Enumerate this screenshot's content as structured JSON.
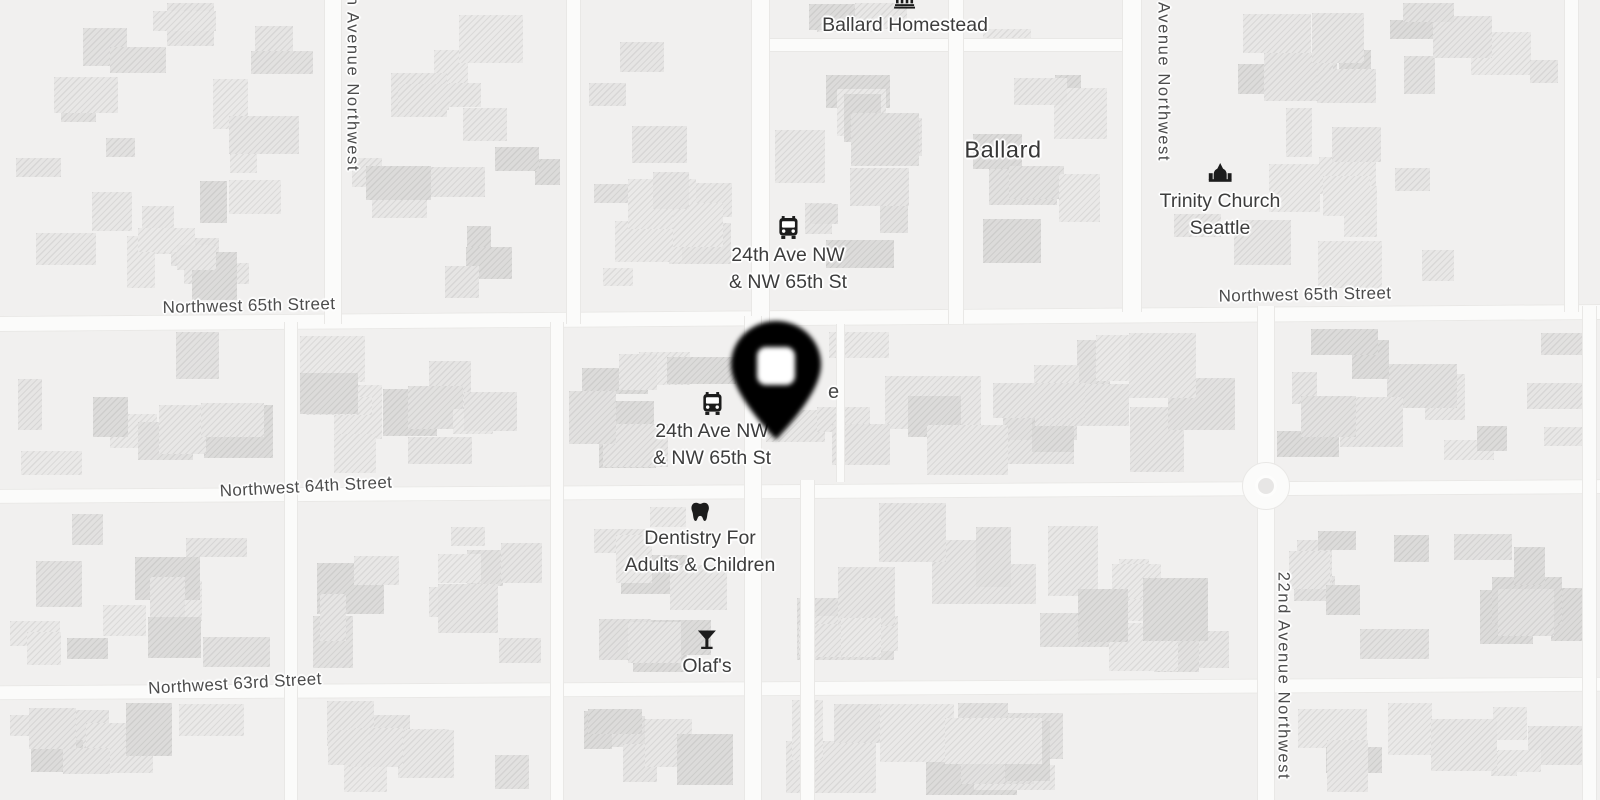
{
  "map": {
    "background_color": "#f1f0ef",
    "road_color": "#fbfbfa",
    "building_color": "#e8e7e6",
    "street_label_color": "#4c4c4c",
    "poi_label_color": "#3d3d3d",
    "place_label_color": "#373737",
    "halo_color": "#ffffff"
  },
  "streets": {
    "nw65_left": "Northwest 65th Street",
    "nw65_right": "Northwest 65th Street",
    "nw64": "Northwest 64th Street",
    "nw63": "Northwest 63rd Street",
    "ave_partial_left": "h Avenue Northwest",
    "ave_partial_right": "Avenue Northwest",
    "ave_22nd": "22nd Avenue Northwest"
  },
  "places": {
    "neighborhood": "Ballard"
  },
  "pois": {
    "ballard_homestead": {
      "name": "Ballard Homestead",
      "icon": "bank-icon"
    },
    "trinity_church": {
      "line1": "Trinity Church",
      "line2": "Seattle",
      "icon": "church-icon"
    },
    "bus_stop_north": {
      "line1": "24th Ave NW",
      "line2": "& NW 65th St",
      "icon": "bus-icon"
    },
    "bus_stop_south": {
      "line1": "24th Ave NW",
      "line2": "& NW 65th St",
      "icon": "bus-icon"
    },
    "dentistry": {
      "line1": "Dentistry For",
      "line2": "Adults & Children",
      "icon": "tooth-icon"
    },
    "olafs": {
      "name": "Olaf's",
      "icon": "cocktail-icon"
    },
    "obscured_label_fragment": "e"
  },
  "marker": {
    "type": "location-pin",
    "color": "#000000",
    "center_color": "#ffffff"
  }
}
